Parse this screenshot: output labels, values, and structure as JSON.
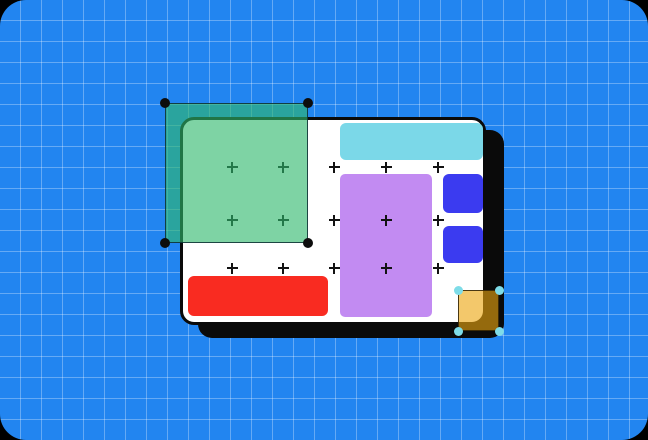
{
  "canvas": {
    "width": 648,
    "height": 440,
    "outer_background": "#000000"
  },
  "background": {
    "color": "#2285f0",
    "corner_radius": 26,
    "grid": {
      "cell_size": 21,
      "line_color": "rgba(255,255,255,0.30)",
      "line_width": 1
    }
  },
  "artboard": {
    "x": 180,
    "y": 117,
    "width": 306,
    "height": 208,
    "fill": "#ffffff",
    "border_color": "#0a0a0a",
    "border_width": 3,
    "corner_radius": 14,
    "shadow_dx": 18,
    "shadow_dy": 13,
    "shadow_color": "#0a0a0a"
  },
  "markers": {
    "symbol": "plus-marker",
    "color": "#121212",
    "size": 11,
    "thickness": 2,
    "columns": [
      232,
      283,
      334,
      386,
      438
    ],
    "rows": [
      167,
      220,
      268
    ]
  },
  "shapes": [
    {
      "name": "cyan-bar",
      "x": 340,
      "y": 123,
      "width": 143,
      "height": 37,
      "radius": 6,
      "fill": "#7bd8e8"
    },
    {
      "name": "purple-rect",
      "x": 340,
      "y": 174,
      "width": 92,
      "height": 143,
      "radius": 5,
      "fill": "#c28bf2"
    },
    {
      "name": "indigo-square-top",
      "x": 443,
      "y": 174,
      "width": 40,
      "height": 39,
      "radius": 6,
      "fill": "#3b3bf0"
    },
    {
      "name": "indigo-square-bottom",
      "x": 443,
      "y": 226,
      "width": 40,
      "height": 37,
      "radius": 6,
      "fill": "#3b3bf0"
    },
    {
      "name": "red-bar",
      "x": 188,
      "y": 276,
      "width": 140,
      "height": 40,
      "radius": 6,
      "fill": "#f92b21"
    }
  ],
  "selections": [
    {
      "name": "selected-green-rect",
      "x": 165,
      "y": 103,
      "width": 143,
      "height": 140,
      "radius": 0,
      "fill": "rgba(46,184,108,0.62)",
      "border_width": 1.5,
      "border_color": "rgba(12,45,50,0.85)",
      "handle_color": "#0d0d0d",
      "handle_size": 10
    },
    {
      "name": "selected-orange-square",
      "x": 458,
      "y": 290,
      "width": 41,
      "height": 41,
      "radius": 5,
      "fill": "rgba(236,166,16,0.62)",
      "border_width": 1.5,
      "border_color": "rgba(45,32,5,0.85)",
      "handle_color": "#7edce8",
      "handle_size": 9
    }
  ]
}
